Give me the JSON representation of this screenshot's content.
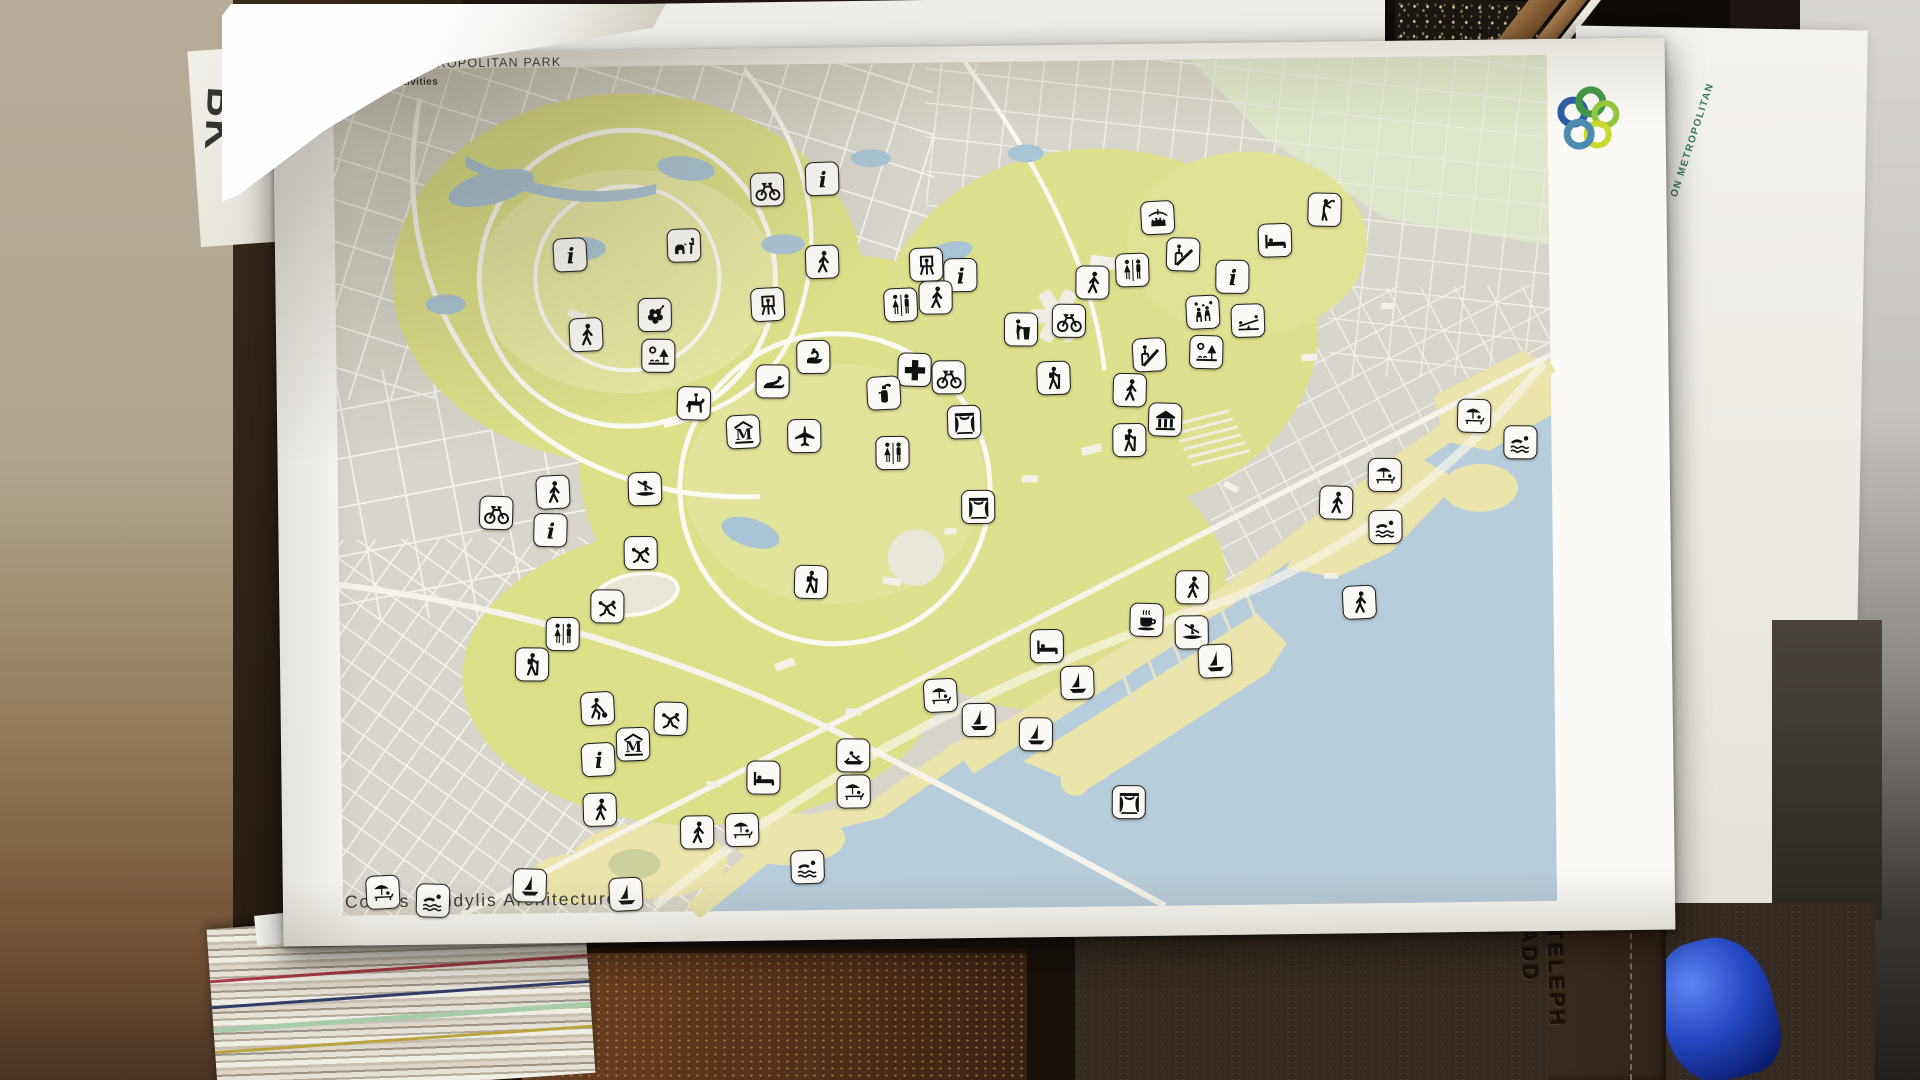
{
  "map": {
    "title": "METROPOLITAN PARK",
    "subtitle": "Program Activities",
    "credit": "Costas Kondylis Architecture",
    "side_sheet_text": "ON METROPOLITAN",
    "logo_ring_colors": [
      "#2e5ba6",
      "#3f9648",
      "#93c83d",
      "#c8d92f",
      "#4d8cb0"
    ],
    "palette": {
      "land": "#d8d5cc",
      "park_green": "#dce089",
      "water": "#b6cddc",
      "sand": "#ebe4ab",
      "roads": "#faf9f2",
      "ne_green": "#dee7c9"
    }
  },
  "background_items": {
    "bk_sheet_text": "BK",
    "phonebook_line1": "TELEPH",
    "phonebook_line2": "ADD"
  },
  "icon_types": {
    "info": "information point",
    "bicycle": "cycling",
    "walker": "walking trail",
    "hiker": "hiking",
    "restroom": "restrooms",
    "firstaid": "first aid",
    "extinguisher": "fire safety",
    "zoo": "zoo animals",
    "flower": "botanical garden",
    "picnic": "picnic area",
    "easel": "art / painting",
    "swan": "bird pond",
    "sealion": "sea life",
    "horse": "horseback riding",
    "museum": "museum",
    "airplane": "aviation exhibit",
    "lecturer": "lecture / podium",
    "slide": "playground slide",
    "stage": "performance stage",
    "temple": "ruins / temple",
    "market": "market stand",
    "bed": "lodging",
    "golfer": "golf",
    "celebration": "festival area",
    "seesaw": "playground seesaw",
    "grappling": "martial arts",
    "soccer": "soccer field",
    "kayak": "kayaking",
    "rowing": "rowing",
    "coffee": "cafe",
    "sailboat": "sailing / marina",
    "swimmer": "swimming",
    "beach": "beach"
  },
  "icons": [
    {
      "t": "info",
      "x": 295,
      "y": 204
    },
    {
      "t": "info",
      "x": 548,
      "y": 131
    },
    {
      "t": "info",
      "x": 685,
      "y": 229
    },
    {
      "t": "info",
      "x": 957,
      "y": 234
    },
    {
      "t": "info",
      "x": 272,
      "y": 479
    },
    {
      "t": "info",
      "x": 317,
      "y": 709
    },
    {
      "t": "bicycle",
      "x": 493,
      "y": 141
    },
    {
      "t": "bicycle",
      "x": 672,
      "y": 331
    },
    {
      "t": "bicycle",
      "x": 793,
      "y": 276
    },
    {
      "t": "bicycle",
      "x": 218,
      "y": 461
    },
    {
      "t": "walker",
      "x": 310,
      "y": 284
    },
    {
      "t": "walker",
      "x": 547,
      "y": 214
    },
    {
      "t": "walker",
      "x": 660,
      "y": 251
    },
    {
      "t": "walker",
      "x": 817,
      "y": 238
    },
    {
      "t": "walker",
      "x": 853,
      "y": 346
    },
    {
      "t": "walker",
      "x": 275,
      "y": 441
    },
    {
      "t": "walker",
      "x": 318,
      "y": 759
    },
    {
      "t": "walker",
      "x": 415,
      "y": 783
    },
    {
      "t": "walker",
      "x": 913,
      "y": 544
    },
    {
      "t": "walker",
      "x": 1058,
      "y": 461
    },
    {
      "t": "walker",
      "x": 1080,
      "y": 561
    },
    {
      "t": "hiker",
      "x": 777,
      "y": 333
    },
    {
      "t": "hiker",
      "x": 852,
      "y": 396
    },
    {
      "t": "hiker",
      "x": 252,
      "y": 613
    },
    {
      "t": "hiker",
      "x": 532,
      "y": 534
    },
    {
      "t": "restroom",
      "x": 625,
      "y": 258
    },
    {
      "t": "restroom",
      "x": 857,
      "y": 226
    },
    {
      "t": "restroom",
      "x": 615,
      "y": 406
    },
    {
      "t": "restroom",
      "x": 283,
      "y": 583
    },
    {
      "t": "firstaid",
      "x": 638,
      "y": 323
    },
    {
      "t": "extinguisher",
      "x": 607,
      "y": 346
    },
    {
      "t": "zoo",
      "x": 409,
      "y": 196
    },
    {
      "t": "flower",
      "x": 379,
      "y": 265
    },
    {
      "t": "picnic",
      "x": 382,
      "y": 306
    },
    {
      "t": "picnic",
      "x": 930,
      "y": 309
    },
    {
      "t": "easel",
      "x": 492,
      "y": 256
    },
    {
      "t": "easel",
      "x": 651,
      "y": 218
    },
    {
      "t": "swan",
      "x": 537,
      "y": 309
    },
    {
      "t": "sealion",
      "x": 496,
      "y": 333
    },
    {
      "t": "horse",
      "x": 417,
      "y": 354
    },
    {
      "t": "museum",
      "x": 466,
      "y": 383
    },
    {
      "t": "museum",
      "x": 352,
      "y": 694
    },
    {
      "t": "airplane",
      "x": 527,
      "y": 388
    },
    {
      "t": "lecturer",
      "x": 745,
      "y": 284
    },
    {
      "t": "slide",
      "x": 908,
      "y": 211
    },
    {
      "t": "slide",
      "x": 873,
      "y": 311
    },
    {
      "t": "stage",
      "x": 687,
      "y": 376
    },
    {
      "t": "stage",
      "x": 700,
      "y": 461
    },
    {
      "t": "stage",
      "x": 847,
      "y": 758
    },
    {
      "t": "temple",
      "x": 888,
      "y": 376
    },
    {
      "t": "market",
      "x": 883,
      "y": 174
    },
    {
      "t": "bed",
      "x": 1000,
      "y": 198
    },
    {
      "t": "bed",
      "x": 767,
      "y": 601
    },
    {
      "t": "bed",
      "x": 482,
      "y": 729
    },
    {
      "t": "golfer",
      "x": 1050,
      "y": 168
    },
    {
      "t": "celebration",
      "x": 927,
      "y": 269
    },
    {
      "t": "seesaw",
      "x": 972,
      "y": 278
    },
    {
      "t": "grappling",
      "x": 362,
      "y": 503
    },
    {
      "t": "grappling",
      "x": 328,
      "y": 556
    },
    {
      "t": "grappling",
      "x": 390,
      "y": 669
    },
    {
      "t": "soccer",
      "x": 317,
      "y": 658
    },
    {
      "t": "kayak",
      "x": 367,
      "y": 439
    },
    {
      "t": "kayak",
      "x": 912,
      "y": 589
    },
    {
      "t": "rowing",
      "x": 572,
      "y": 708
    },
    {
      "t": "coffee",
      "x": 867,
      "y": 576
    },
    {
      "t": "sailboat",
      "x": 935,
      "y": 618
    },
    {
      "t": "sailboat",
      "x": 797,
      "y": 638
    },
    {
      "t": "sailboat",
      "x": 698,
      "y": 674
    },
    {
      "t": "sailboat",
      "x": 755,
      "y": 689
    },
    {
      "t": "sailboat",
      "x": 247,
      "y": 834
    },
    {
      "t": "sailboat",
      "x": 343,
      "y": 844
    },
    {
      "t": "swimmer",
      "x": 525,
      "y": 819
    },
    {
      "t": "swimmer",
      "x": 1107,
      "y": 486
    },
    {
      "t": "swimmer",
      "x": 1243,
      "y": 403
    },
    {
      "t": "swimmer",
      "x": 150,
      "y": 848
    },
    {
      "t": "beach",
      "x": 660,
      "y": 649
    },
    {
      "t": "beach",
      "x": 460,
      "y": 781
    },
    {
      "t": "beach",
      "x": 572,
      "y": 744
    },
    {
      "t": "beach",
      "x": 1107,
      "y": 434
    },
    {
      "t": "beach",
      "x": 1197,
      "y": 376
    },
    {
      "t": "beach",
      "x": 100,
      "y": 839
    }
  ]
}
